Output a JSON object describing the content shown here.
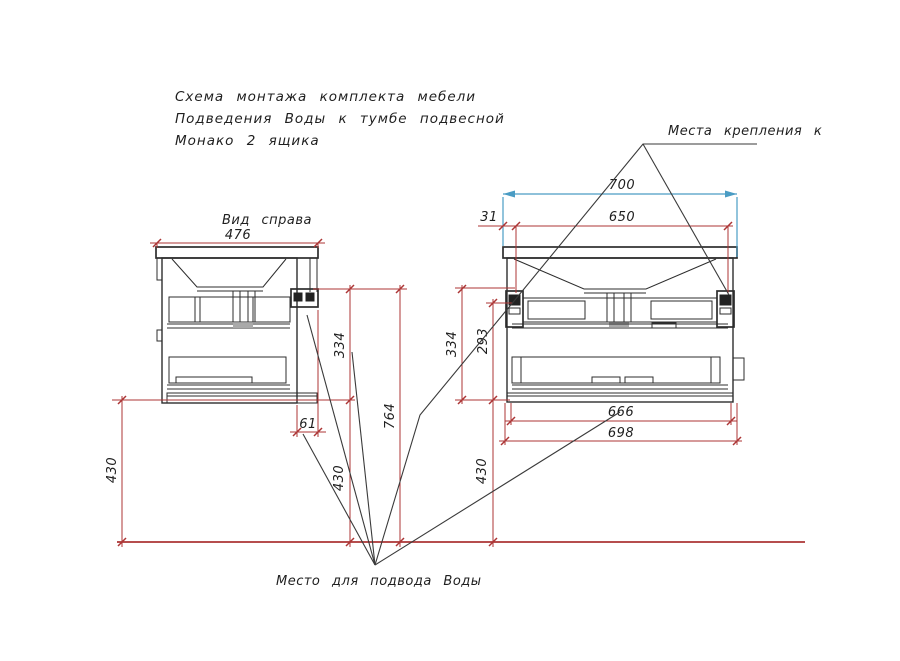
{
  "title": {
    "line1": "Схема монтажа комплекта мебели",
    "line2": "Подведения Воды к тумбе подвесной",
    "line3": "Монако 2 ящика"
  },
  "labels": {
    "side_view": "Вид справа",
    "mounting": "Места крепления к",
    "water": "Место для подвода Воды"
  },
  "dims": {
    "sv_width": "476",
    "sv_offset": "61",
    "sv_h334": "334",
    "sv_h430": "430",
    "sv_total": "764",
    "left_floor": "430",
    "fv_top": "700",
    "fv_mount": "650",
    "fv_edge": "31",
    "fv_h334": "334",
    "fv_h293": "293",
    "fv_floor": "430",
    "fv_inner": "666",
    "fv_box": "698"
  },
  "colors": {
    "dimension_red": "#ac3535",
    "accent_blue": "#4a9cc4",
    "drawing_line": "#2d2d2d",
    "background": "#ffffff"
  }
}
